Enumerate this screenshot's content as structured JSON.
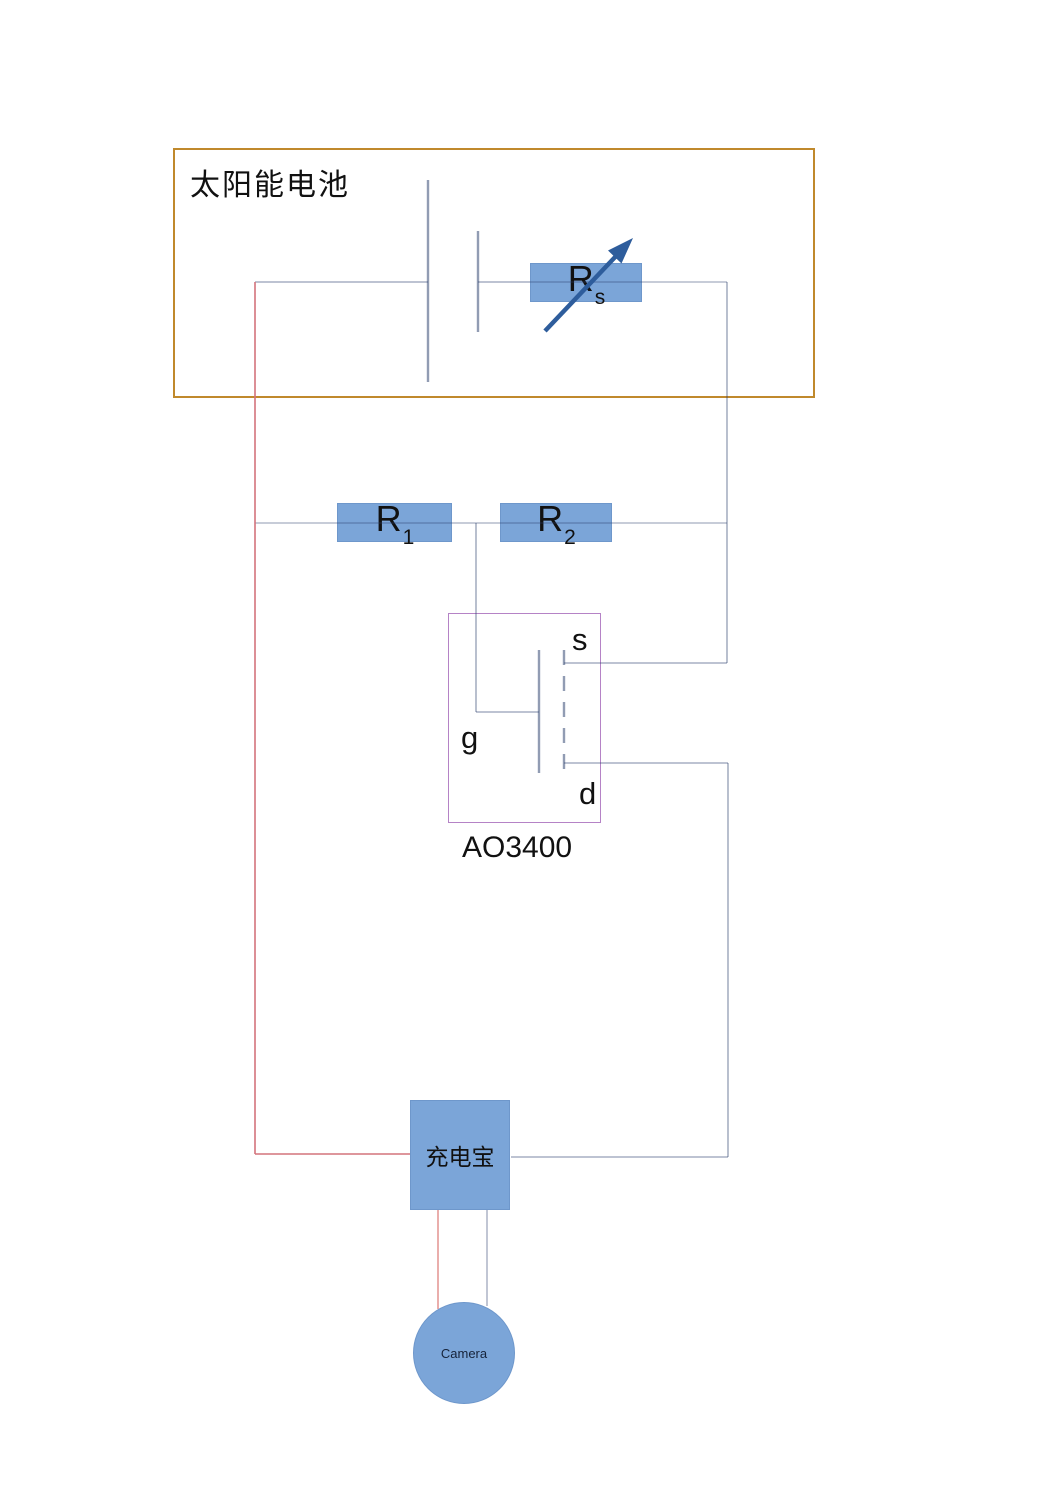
{
  "solar_module": {
    "label": "太阳能电池"
  },
  "variable_resistor": {
    "base": "R",
    "sub": "s"
  },
  "resistor_r1": {
    "base": "R",
    "sub": "1"
  },
  "resistor_r2": {
    "base": "R",
    "sub": "2"
  },
  "mosfet": {
    "part_number": "AO3400",
    "pin_source": "s",
    "pin_gate": "g",
    "pin_drain": "d"
  },
  "powerbank": {
    "label": "充电宝"
  },
  "camera": {
    "label": "Camera"
  },
  "colors": {
    "component_fill": "#7BA5D8",
    "component_border": "#6E97CB",
    "solar_box_border": "#C0892C",
    "mosfet_box_border": "#B583C6",
    "wire_blue": "#9FAECB",
    "wire_red": "#D4737C",
    "arrow_blue": "#2E5D9C"
  }
}
